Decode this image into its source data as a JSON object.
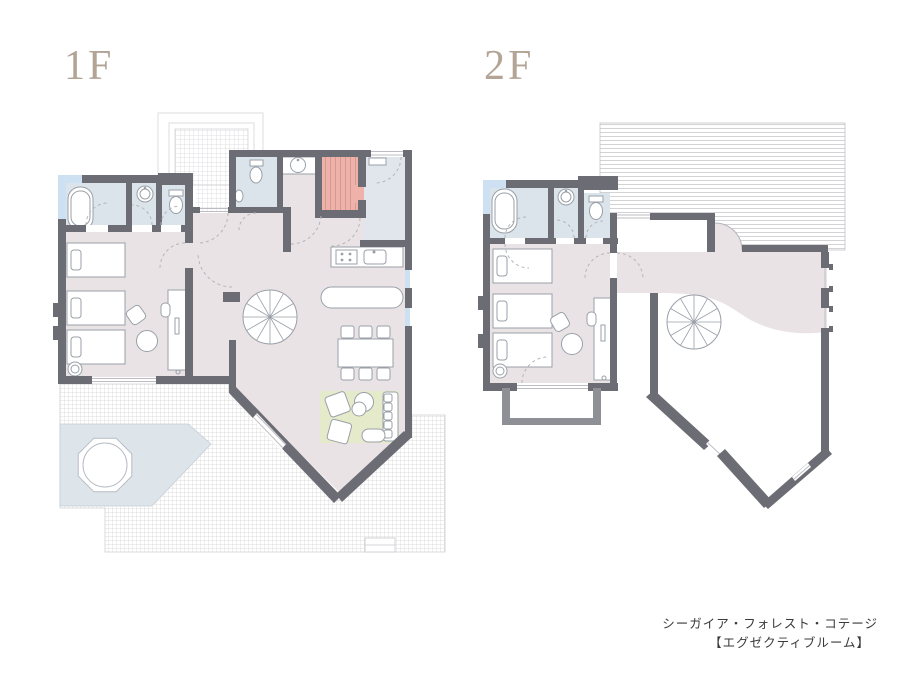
{
  "page": {
    "background": "#ffffff"
  },
  "floors": [
    {
      "id": "1f",
      "label": "1F"
    },
    {
      "id": "2f",
      "label": "2F"
    }
  ],
  "caption": {
    "line1": "シーガイア・フォレスト・コテージ",
    "line2": "【エグゼクティブルーム】"
  },
  "colors": {
    "page_bg": "#ffffff",
    "label_text": "#b3a496",
    "caption_text": "#3a3a3a",
    "wall": "#6c6c74",
    "balcony_wall": "#8f8f96",
    "floor_pink": "#e9e3e5",
    "floor_blue": "#dbe3eb",
    "floor_genkan": "#e1e5ec",
    "glass": "#cde1f2",
    "rug_green": "#e5eaca",
    "stairs_salmon": "#efb2aa",
    "platform_blue": "#dde4ea",
    "furniture_line": "#9aa0a8",
    "door_arc": "#b4b4bc"
  }
}
